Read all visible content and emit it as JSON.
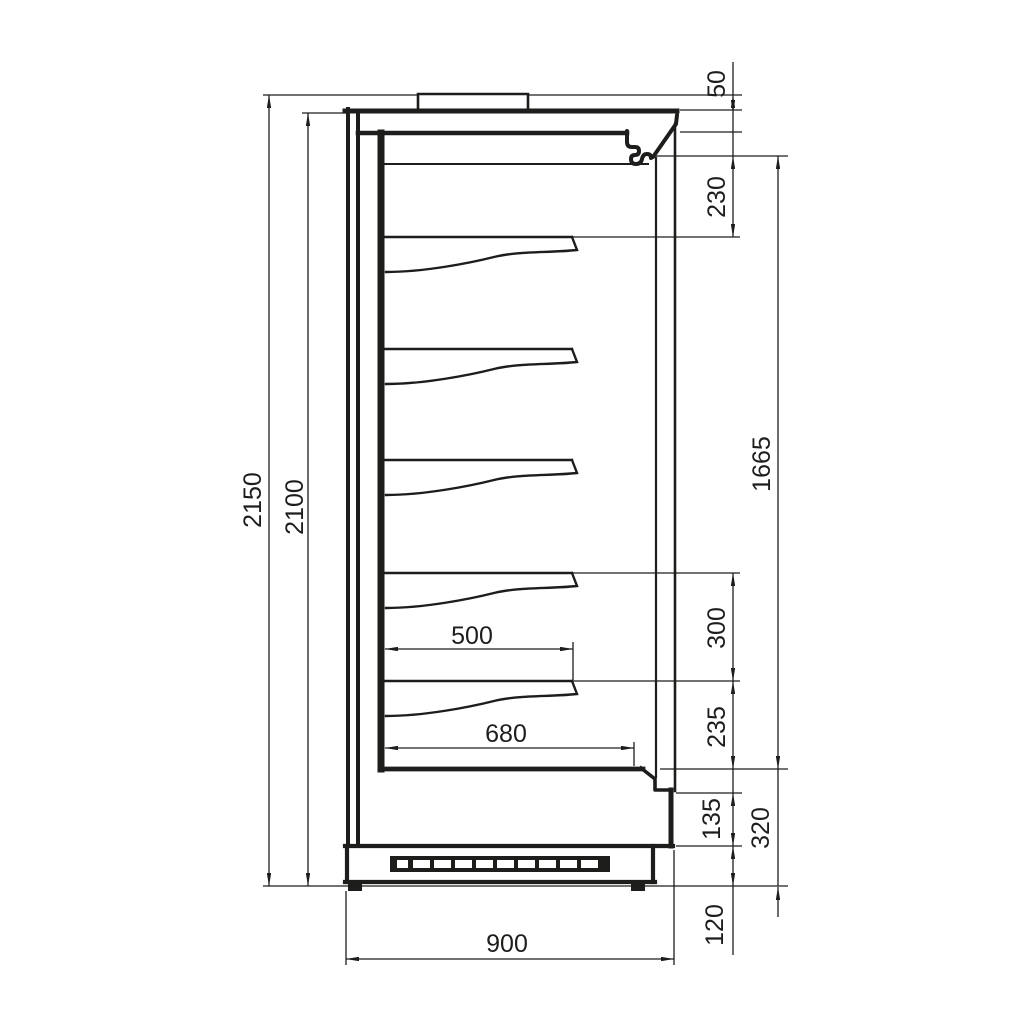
{
  "drawing": {
    "type": "technical-side-section",
    "subject": "refrigerated multideck display cabinet - side section with dimensions",
    "line_color": "#1d1d1b",
    "background": "#ffffff",
    "units": "mm",
    "dimensions": {
      "overall_height": "2150",
      "body_height": "2100",
      "canopy_cap": "50",
      "top_duct": "230",
      "display_opening": "1665",
      "shelf_pitch": "300",
      "lower_gap": "235",
      "front_panel": "135",
      "base_total": "320",
      "plinth": "120",
      "shelf_depth": "500",
      "deck_depth": "680",
      "overall_depth": "900"
    }
  }
}
